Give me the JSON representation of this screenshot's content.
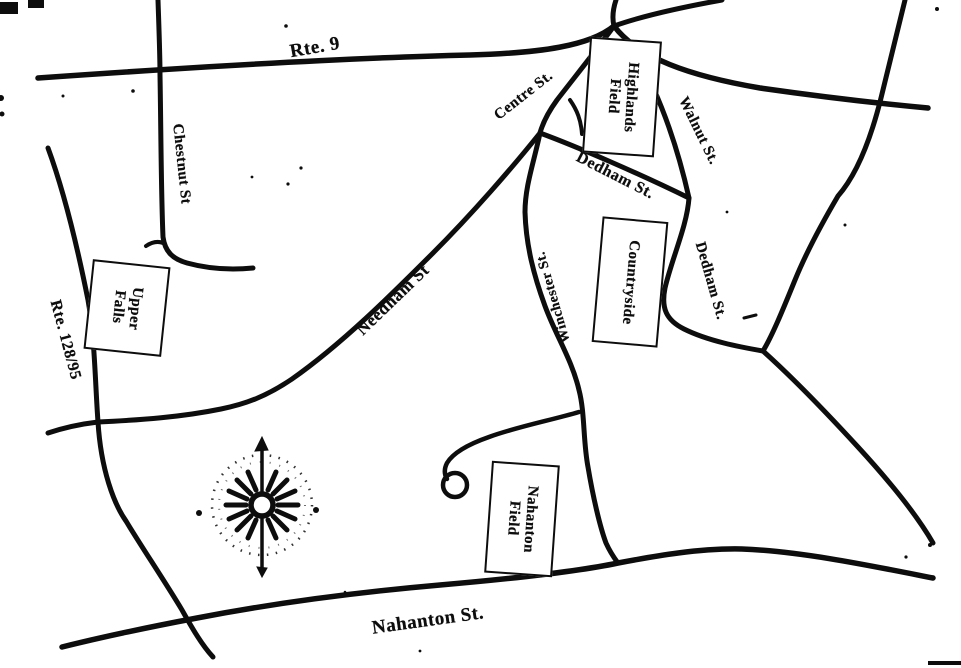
{
  "colors": {
    "ink": "#0d0d0d",
    "paper": "#ffffff"
  },
  "roads": {
    "rte_9": {
      "label": "Rte. 9"
    },
    "centre_st": {
      "label": "Centre St."
    },
    "walnut_st": {
      "label": "Walnut St."
    },
    "dedham_st_upper": {
      "label": "Dedham St."
    },
    "dedham_st_lower": {
      "label": "Dedham St."
    },
    "winchester_st": {
      "label": "Winchester St."
    },
    "needham_st": {
      "label": "Needham St"
    },
    "chestnut_st": {
      "label": "Chestnut St"
    },
    "rte_128_95": {
      "label": "Rte. 128/95"
    },
    "nahanton_st": {
      "label": "Nahanton St."
    }
  },
  "places": {
    "highlands_field": {
      "line1": "Highlands",
      "line2": "Field"
    },
    "countryside": {
      "line1": "Countryside"
    },
    "upper_falls": {
      "line1": "Upper",
      "line2": "Falls"
    },
    "nahanton_field": {
      "line1": "Nahanton",
      "line2": "Field"
    }
  },
  "compass": {
    "type": "compass-rose",
    "north_marker": "arrow"
  }
}
